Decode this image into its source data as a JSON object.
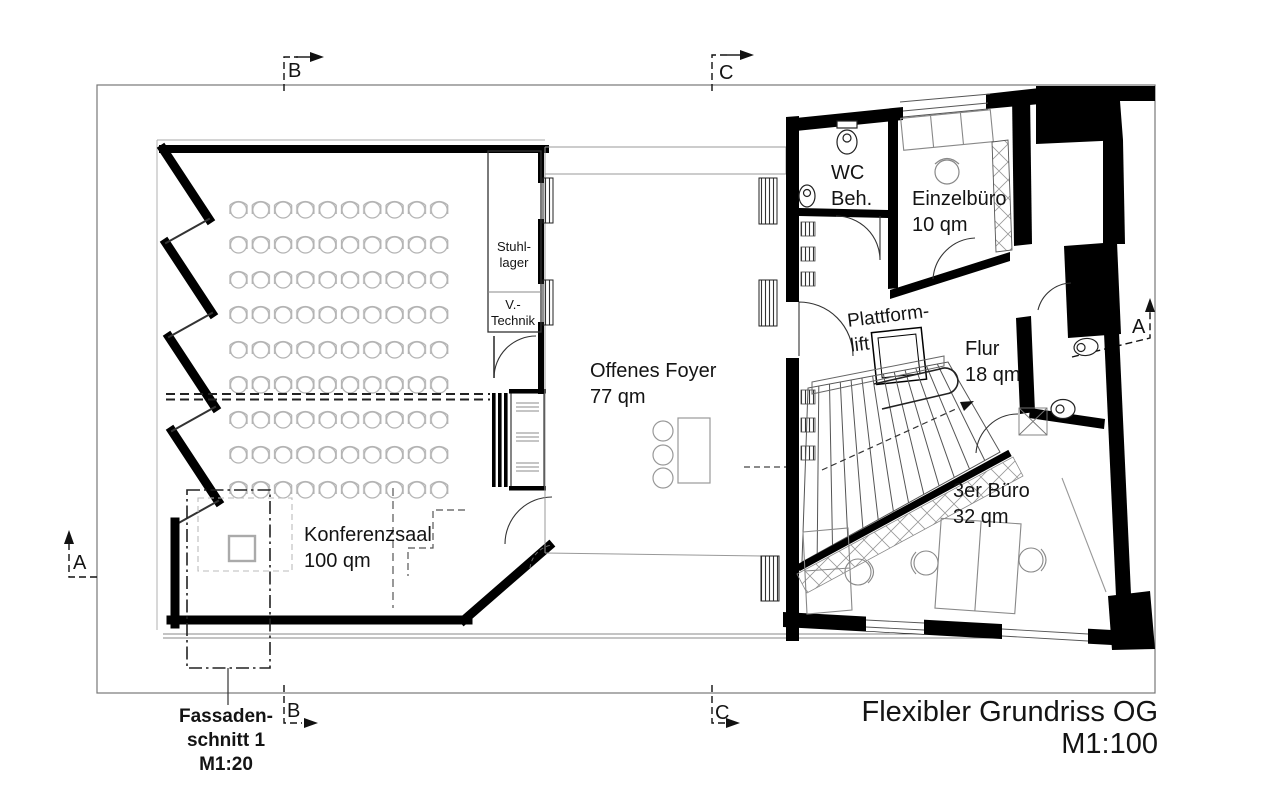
{
  "drawing": {
    "title": "Flexibler Grundriss OG",
    "scale": "M1:100",
    "facade_section": {
      "line1": "Fassaden-",
      "line2": "schnitt 1",
      "scale": "M1:20"
    }
  },
  "rooms": {
    "konferenzsaal": {
      "name": "Konferenzsaal",
      "area": "100 qm"
    },
    "offenes_foyer": {
      "name": "Offenes Foyer",
      "area": "77 qm"
    },
    "stuhllager": {
      "line1": "Stuhl-",
      "line2": "lager"
    },
    "v_technik": {
      "line1": "V.-",
      "line2": "Technik"
    },
    "wc_beh": {
      "line1": "WC",
      "line2": "Beh."
    },
    "einzelbuero": {
      "name": "Einzelbüro",
      "area": "10 qm"
    },
    "plattformlift": {
      "line1": "Plattform-",
      "line2": "lift"
    },
    "flur": {
      "name": "Flur",
      "area": "18 qm"
    },
    "dreier_buero": {
      "name": "3er Büro",
      "area": "32 qm"
    }
  },
  "section_markers": {
    "a_left": "A",
    "a_right": "A",
    "b_top": "B",
    "b_bottom": "B",
    "c_top": "C",
    "c_bottom": "C"
  },
  "colors": {
    "walls": "#000000",
    "thin_lines": "#555555",
    "furniture": "#b3b3b3",
    "background": "#ffffff"
  }
}
